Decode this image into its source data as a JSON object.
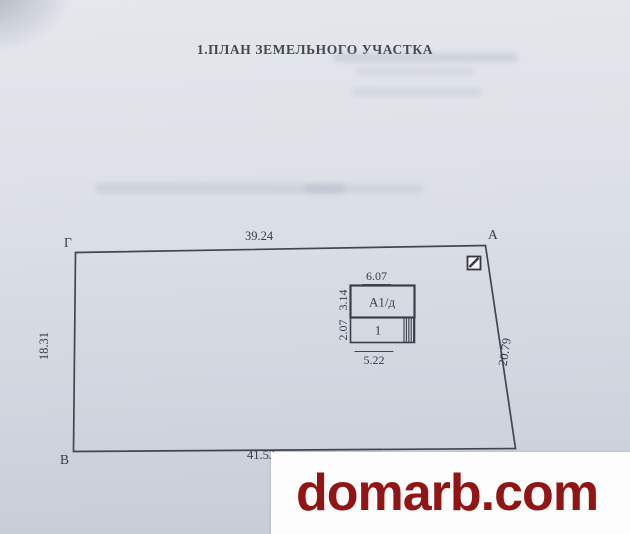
{
  "title": "1.ПЛАН ЗЕМЕЛЬНОГО УЧАСТКА",
  "plan": {
    "corners": {
      "top_left": "Г",
      "top_right": "А",
      "bottom_left": "В"
    },
    "dimensions": {
      "top": "39.24",
      "left": "18.31",
      "right": "20.79",
      "bottom": "41.53"
    },
    "building": {
      "label_upper": "А1/д",
      "label_lower": "1",
      "dim_width_top": "6.07",
      "dim_width_bottom": "5.22",
      "dim_height_upper": "3.14",
      "dim_height_lower": "2.07"
    },
    "symbols": {
      "marker_icon": "square-with-diagonal-marker"
    }
  },
  "watermark": {
    "text": "domarb.com",
    "color": "#911515",
    "background": "#fcfcfd"
  },
  "colors": {
    "paper_top": "#e4e7ec",
    "paper_bottom": "#c7ccd6",
    "line": "#42464f",
    "text": "#3c4150"
  }
}
